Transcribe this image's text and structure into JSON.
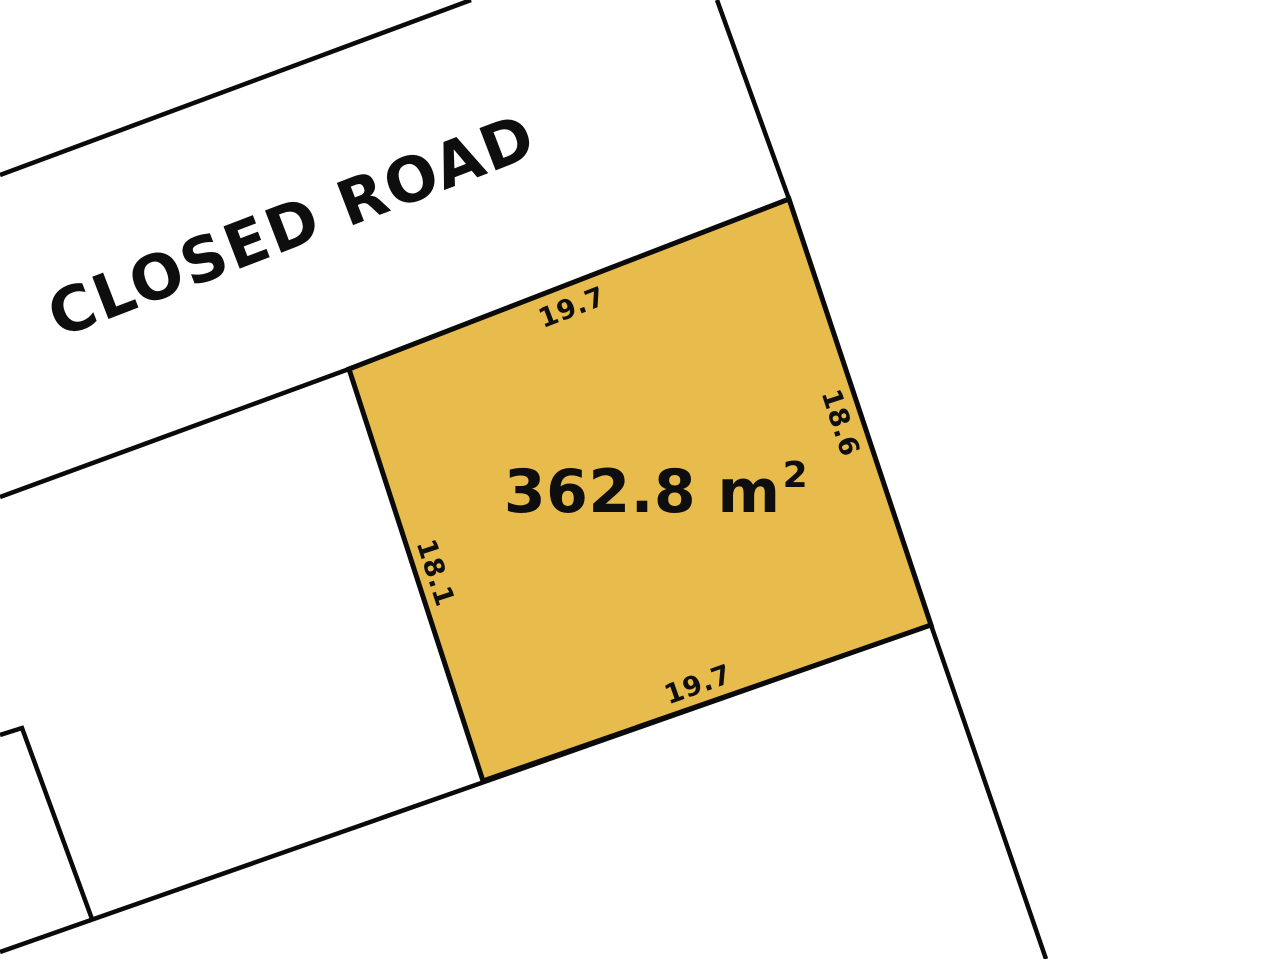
{
  "road": {
    "label": "CLOSED ROAD"
  },
  "parcel": {
    "area_text": "362.8 m",
    "area_exponent": "2",
    "dimensions": {
      "top": "19.7",
      "right": "18.6",
      "bottom": "19.7",
      "left": "18.1"
    }
  },
  "colors": {
    "parcel_fill": "#E8BB4D",
    "boundary_line": "#0A0A0A",
    "background": "#FFFFFF",
    "text": "#0E0E0E"
  }
}
